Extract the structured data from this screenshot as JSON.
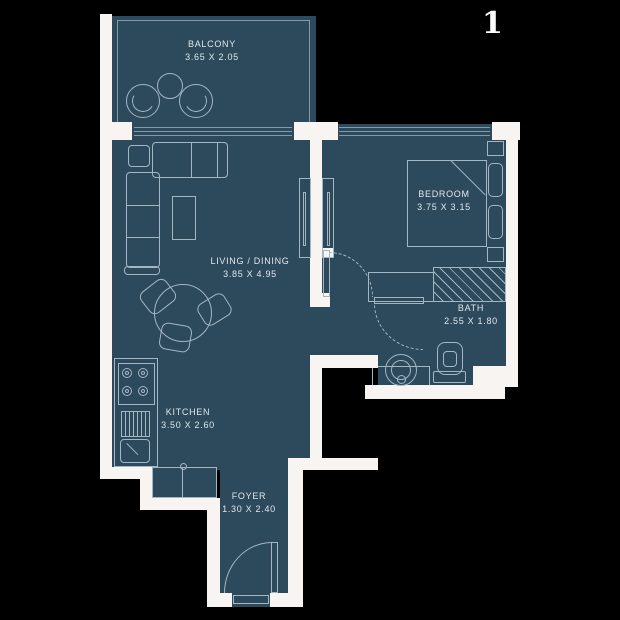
{
  "unit": {
    "number": "1"
  },
  "colors": {
    "background": "#000000",
    "room_fill": "#2d495c",
    "wall": "#f7f4f1",
    "line": "#a3b7c2",
    "line_soft": "#849aa7",
    "text": "#dfe8ec"
  },
  "rooms": [
    {
      "name": "BALCONY",
      "dimensions": "3.65 X 2.05"
    },
    {
      "name": "LIVING / DINING",
      "dimensions": "3.85 X 4.95"
    },
    {
      "name": "BEDROOM",
      "dimensions": "3.75 X 3.15"
    },
    {
      "name": "BATH",
      "dimensions": "2.55 X 1.80"
    },
    {
      "name": "KITCHEN",
      "dimensions": "3.50 X 2.60"
    },
    {
      "name": "FOYER",
      "dimensions": "1.30 X 2.40"
    }
  ]
}
